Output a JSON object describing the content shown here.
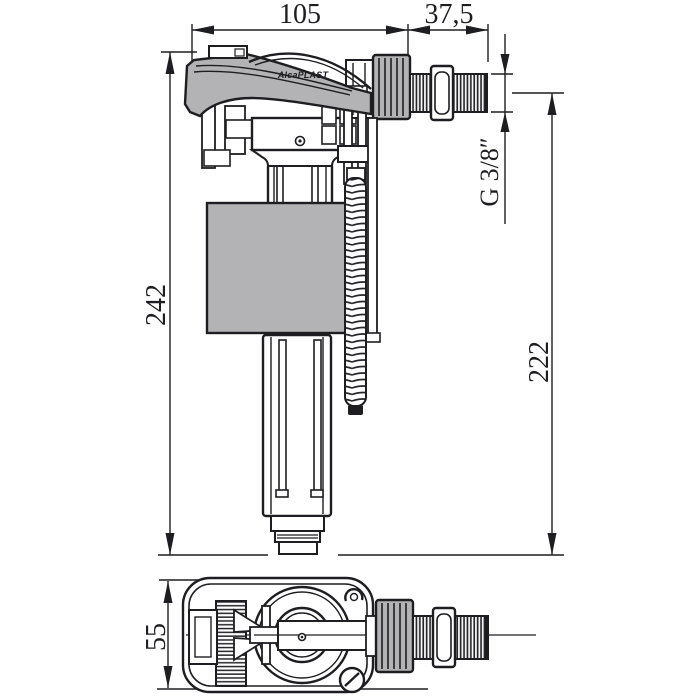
{
  "drawing": {
    "brand_label": "AlcaPLAST",
    "colors": {
      "line": "#1e1e22",
      "part_fill": "#b3b3b5",
      "background": "#ffffff"
    },
    "dimensions": {
      "d105": "105",
      "d375": "37,5",
      "d242": "242",
      "d222": "222",
      "thread": "G 3/8″",
      "d55": "55"
    }
  }
}
